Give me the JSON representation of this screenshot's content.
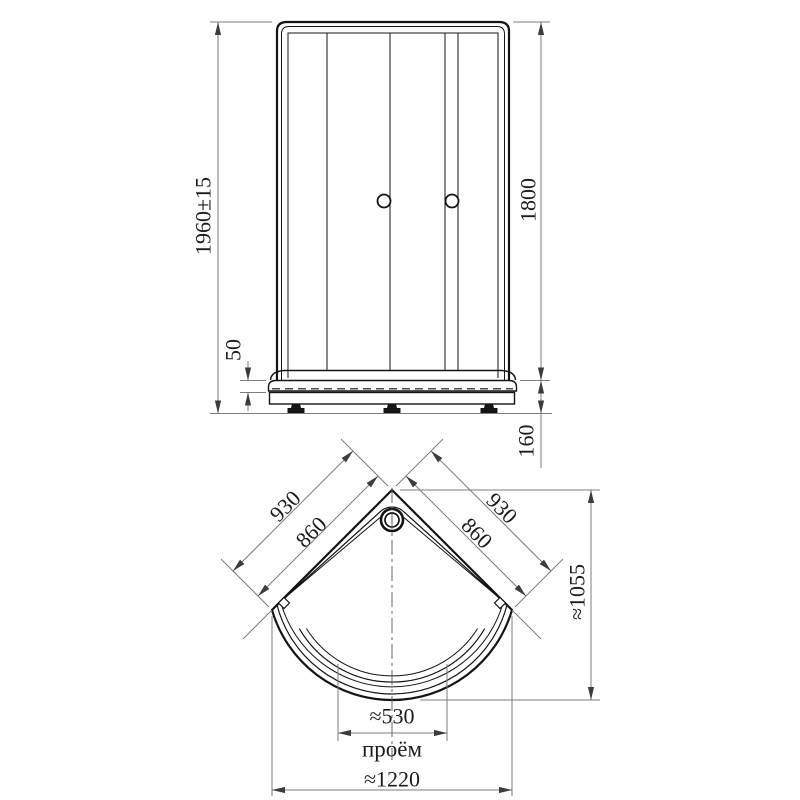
{
  "front_view": {
    "dim_total_height": "1960±15",
    "dim_door_height": "1800",
    "dim_rim_height": "50",
    "dim_base_height": "160"
  },
  "plan_view": {
    "dim_left_outer": "930",
    "dim_left_inner": "860",
    "dim_right_outer": "930",
    "dim_right_inner": "860",
    "dim_depth": "≈1055",
    "dim_opening": "≈530",
    "opening_caption": "проём",
    "dim_total_width": "≈1220"
  }
}
